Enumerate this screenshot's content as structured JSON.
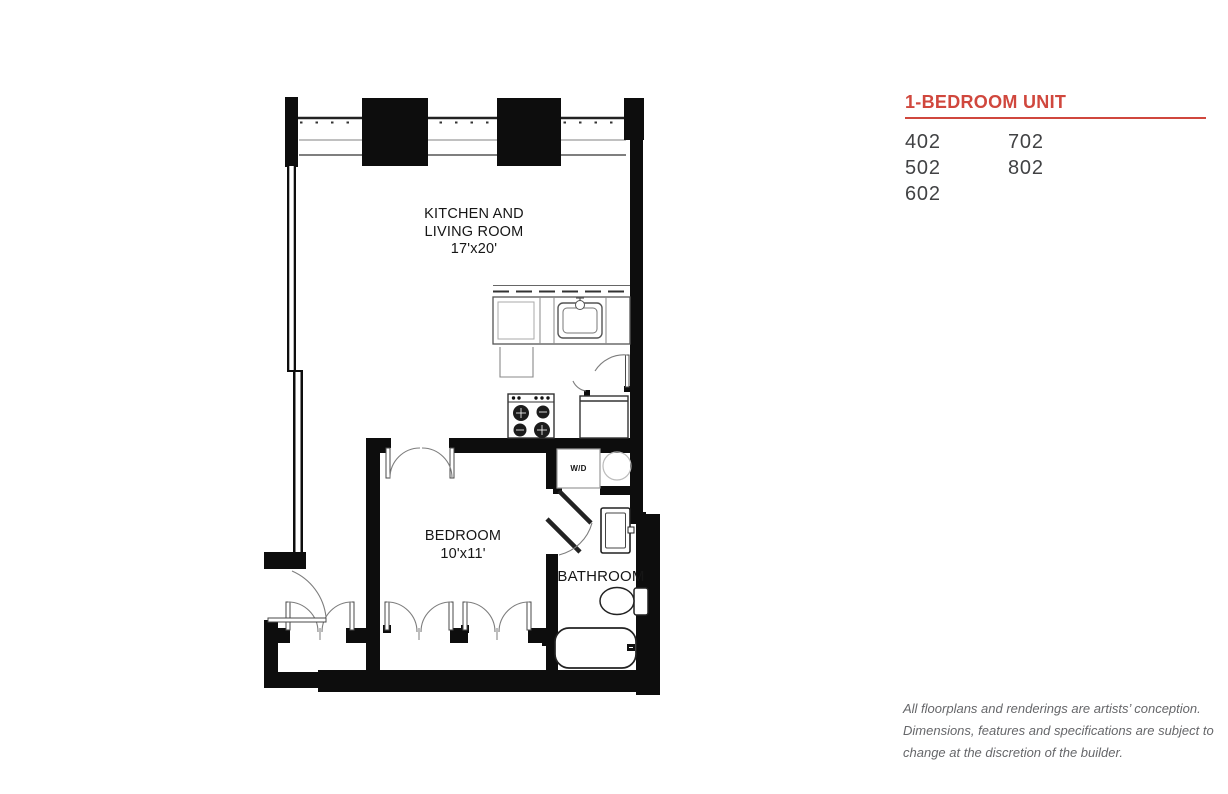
{
  "panel": {
    "title": "1-BEDROOM UNIT",
    "accent_color": "#d0473d",
    "units_col1": [
      "402",
      "502",
      "602"
    ],
    "units_col2": [
      "702",
      "802"
    ],
    "disclaimer_line1": "All floorplans and renderings are artists’ conception.",
    "disclaimer_line2": "Dimensions, features and specifications are subject to",
    "disclaimer_line3": "change at the discretion of the builder."
  },
  "floorplan": {
    "rooms": {
      "kitchen_living": {
        "name_line1": "KITCHEN AND",
        "name_line2": "LIVING ROOM",
        "dimensions": "17'x20'"
      },
      "bedroom": {
        "name": "BEDROOM",
        "dimensions": "10'x11'"
      },
      "bathroom": {
        "name": "BATHROOM"
      },
      "washer_dryer": {
        "label": "W/D"
      }
    }
  }
}
